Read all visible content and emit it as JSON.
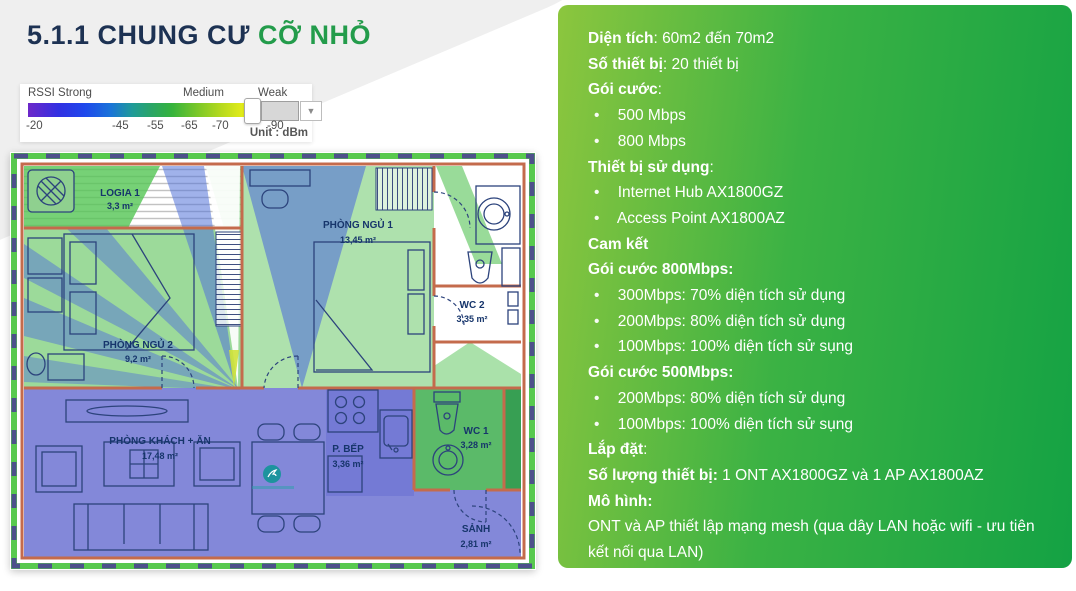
{
  "title": {
    "prefix": "5.1.1 CHUNG CƯ ",
    "highlight": "CỠ NHỎ"
  },
  "legend": {
    "label_strong": "RSSI Strong",
    "label_medium": "Medium",
    "label_weak": "Weak",
    "ticks": [
      "-20",
      "-45",
      "-55",
      "-65",
      "-70",
      "-90"
    ],
    "unit": "Unit : dBm",
    "dropdown_caret": "▼"
  },
  "colors": {
    "title_navy": "#1d3253",
    "title_green": "#239c4b",
    "panel_gradient_start": "#8cc63e",
    "panel_gradient_end": "#14a244",
    "heat_strong_blue": "#7277d4",
    "heat_medium_green": "#5ec45c",
    "wall_orange": "#c46b4c"
  },
  "floorplan": {
    "rooms": [
      {
        "name": "LOGIA 1",
        "area": "3,3 m²"
      },
      {
        "name": "PHÒNG NGỦ 2",
        "area": "9,2 m²"
      },
      {
        "name": "PHÒNG NGỦ 1",
        "area": "13,45 m²"
      },
      {
        "name": "WC 2",
        "area": "3,35 m²"
      },
      {
        "name": "WC 1",
        "area": "3,28 m²"
      },
      {
        "name": "PHÒNG KHÁCH + ĂN",
        "area": "17,48 m²"
      },
      {
        "name": "P. BẾP",
        "area": "3,36 m²"
      },
      {
        "name": "SẢNH",
        "area": "2,81 m²"
      }
    ]
  },
  "panel": {
    "lines": [
      {
        "type": "kv",
        "b": "Diện tích",
        "t": ": 60m2 đến 70m2"
      },
      {
        "type": "kv",
        "b": "Số thiết bị",
        "t": ": 20 thiết bị"
      },
      {
        "type": "kv",
        "b": "Gói cước",
        "t": ":"
      },
      {
        "type": "bullet",
        "b": "",
        "t": "500 Mbps"
      },
      {
        "type": "bullet",
        "b": "",
        "t": "800 Mbps"
      },
      {
        "type": "kv",
        "b": "Thiết bị sử dụng",
        "t": ":"
      },
      {
        "type": "bullet",
        "b": "",
        "t": "Internet Hub AX1800GZ"
      },
      {
        "type": "bullet",
        "b": "",
        "t": "Access Point AX1800AZ"
      },
      {
        "type": "kv",
        "b": "Cam kết",
        "t": ""
      },
      {
        "type": "kv",
        "b": "Gói cước 800Mbps:",
        "t": ""
      },
      {
        "type": "bullet",
        "b": "",
        "t": "300Mbps: 70% diện tích sử dụng"
      },
      {
        "type": "bullet",
        "b": "",
        "t": "200Mbps: 80% diện tích sử dụng"
      },
      {
        "type": "bullet",
        "b": "",
        "t": "100Mbps: 100% diện tích sử sụng"
      },
      {
        "type": "kv",
        "b": "Gói cước 500Mbps:",
        "t": ""
      },
      {
        "type": "bullet",
        "b": "",
        "t": "200Mbps: 80% diện tích sử dụng"
      },
      {
        "type": "bullet",
        "b": "",
        "t": "100Mbps: 100% diện tích sử sụng"
      },
      {
        "type": "kv",
        "b": "Lắp đặt",
        "t": ":"
      },
      {
        "type": "kv",
        "b": "Số lượng thiết bị:",
        "t": " 1 ONT AX1800GZ và 1 AP AX1800AZ"
      },
      {
        "type": "kv",
        "b": "Mô hình:",
        "t": ""
      },
      {
        "type": "text",
        "b": "",
        "t": "ONT và AP thiết lập mạng mesh (qua dây LAN hoặc wifi - ưu tiên kết nối qua LAN)"
      },
      {
        "type": "text",
        "b": "",
        "t": "Không setup mô hình mesh 3 cấp"
      }
    ]
  }
}
